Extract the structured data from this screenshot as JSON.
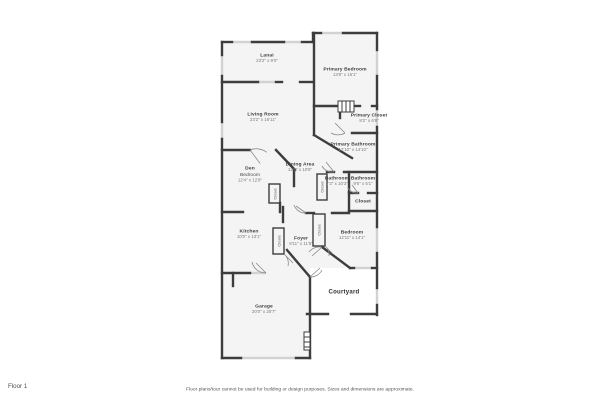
{
  "page": {
    "floor_label": "Floor 1",
    "disclaimer": "Floor plans/tour cannot be used for building or design purposes. Sizes and dimensions are approximate."
  },
  "colors": {
    "wall": "#3d3d3d",
    "window": "#d2d2d2",
    "room_fill": "#f4f4f4",
    "door_arc": "#8a8a8a",
    "label_text": "#3c3c3c",
    "dims_text": "#7a7a7a"
  },
  "rooms": [
    {
      "name": "Lanai",
      "dims": "23'2\" x 9'0\""
    },
    {
      "name": "Primary Bedroom",
      "dims": "13'8\" x 16'1\""
    },
    {
      "name": "Living Room",
      "dims": "23'2\" x 16'11\""
    },
    {
      "name": "Primary Closet",
      "dims": "8'2\" x 6'8\""
    },
    {
      "name": "Primary Bathroom",
      "dims": "12'10\" x 14'10\""
    },
    {
      "name": "Den",
      "sub": "Bedroom",
      "dims": "12'4\" x 12'8\""
    },
    {
      "name": "Dining Area",
      "dims": "12'8\" x 10'8\""
    },
    {
      "name": "Bathroom",
      "dims": "7'2\" x 10'3\""
    },
    {
      "name": "Bathroom",
      "dims": "9'6\" x 5'1\""
    },
    {
      "name": "Closet",
      "dims": ""
    },
    {
      "name": "Kitchen",
      "dims": "10'0\" x 13'1\""
    },
    {
      "name": "Foyer",
      "dims": "8'11\" x 11'8\""
    },
    {
      "name": "Bedroom",
      "dims": "12'11\" x 14'1\""
    },
    {
      "name": "Courtyard",
      "dims": ""
    },
    {
      "name": "Garage",
      "dims": "20'0\" x 20'7\""
    }
  ],
  "closets": [
    {
      "label": "Closet"
    },
    {
      "label": "Closet"
    },
    {
      "label": "Closet"
    },
    {
      "label": "Closet"
    }
  ]
}
